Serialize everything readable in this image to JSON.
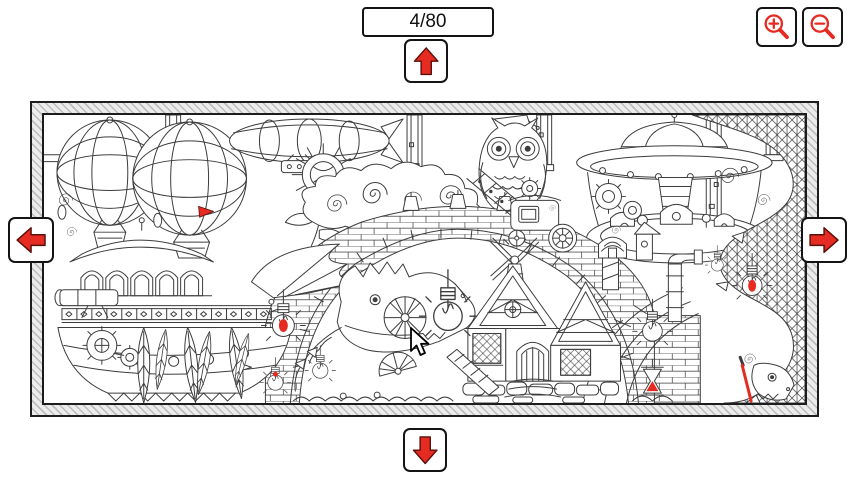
{
  "counter": {
    "value": "4/80"
  },
  "controls": {
    "up": {
      "label": "Scroll up",
      "icon": "arrow-up-icon"
    },
    "down": {
      "label": "Scroll down",
      "icon": "arrow-down-icon"
    },
    "left": {
      "label": "Scroll left",
      "icon": "arrow-left-icon"
    },
    "right": {
      "label": "Scroll right",
      "icon": "arrow-right-icon"
    },
    "zoom_in": {
      "label": "Zoom in",
      "icon": "magnifier-plus-icon"
    },
    "zoom_out": {
      "label": "Zoom out",
      "icon": "magnifier-minus-icon"
    }
  },
  "colors": {
    "accent_red": "#e52b22",
    "accent_dark": "#5a100a",
    "button_border": "#141414",
    "line_art": "#3d3d3d",
    "frame_fill": "#ececec",
    "frame_stripe": "#bdbdbd",
    "canvas_background": "#ffffff"
  },
  "scene": {
    "kind": "black-and-white line-art coloring illustration (steampunk fantasy)",
    "elements": [
      "hot-air-balloons",
      "airship-zeppelin",
      "mechanical-owl",
      "flying-saucer-with-village",
      "scaled-dragon",
      "brick-arch-bridge",
      "steampunk-ship-with-railing",
      "cottage-with-windmill",
      "clouds-with-spiral-curls",
      "hanging-light-bulbs",
      "gears",
      "hanging-leaves",
      "pillars",
      "carriage",
      "dominoes",
      "hourglass",
      "fan-shell"
    ],
    "colored_accents": [
      "red-pennant",
      "red-bulb-filaments",
      "red-hourglass-sand",
      "red-paint-stroke"
    ]
  }
}
